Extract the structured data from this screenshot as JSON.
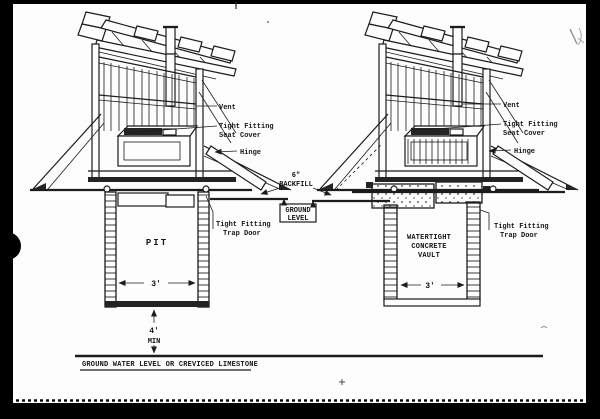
{
  "page": {
    "ink_color": "#1c1c1c",
    "paper_color": "#fdfdfd",
    "frame_color": "#000000"
  },
  "diagram": {
    "left": {
      "vent": "Vent",
      "seat_cover_line1": "Tight Fitting",
      "seat_cover_line2": "Seat Cover",
      "hinge": "Hinge",
      "trap_door_line1": "Tight Fitting",
      "trap_door_line2": "Trap Door",
      "chamber": "PIT",
      "width_dim": "3'",
      "depth_dim_line1": "4'",
      "depth_dim_line2": "MIN"
    },
    "center": {
      "backfill_line1": "6\"",
      "backfill_line2": "BACKFILL",
      "ground_level_line1": "GROUND",
      "ground_level_line2": "LEVEL"
    },
    "right": {
      "vent": "Vent",
      "seat_cover_line1": "Tight Fitting",
      "seat_cover_line2": "Seat Cover",
      "hinge": "Hinge",
      "trap_door_line1": "Tight Fitting",
      "trap_door_line2": "Trap Door",
      "chamber_line1": "WATERTIGHT",
      "chamber_line2": "CONCRETE",
      "chamber_line3": "VAULT",
      "width_dim": "3'"
    },
    "baseline_label": "GROUND WATER LEVEL OR CREVICED LIMESTONE"
  }
}
